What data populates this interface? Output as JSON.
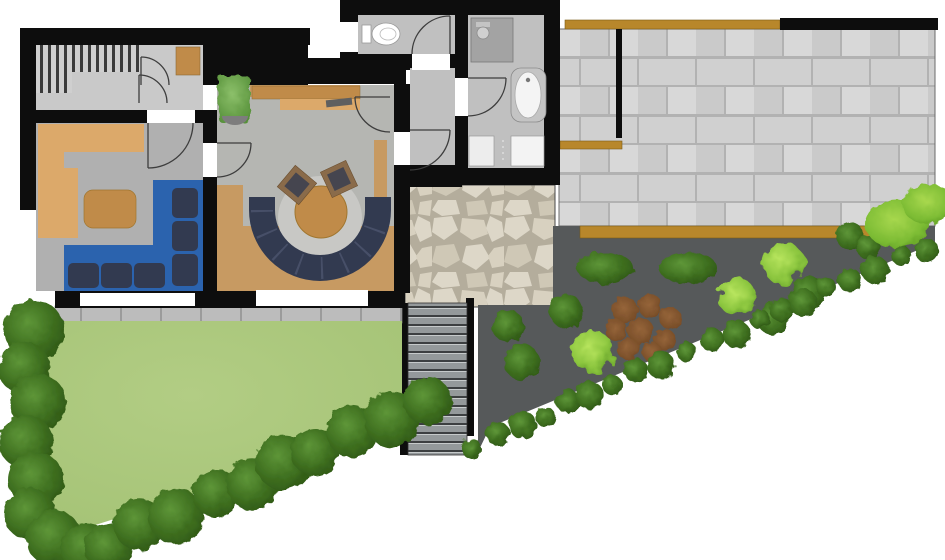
{
  "title": "Residential ground-floor plan with terrace and garden",
  "colors": {
    "wall": "#0d0d0d",
    "floor_a": "#c9c9c9",
    "floor_b": "#b0b0b0",
    "floor_c": "#b5b6b2",
    "floor_d": "#c0c0c0",
    "wood": "#c79a62",
    "wood_light": "#dca96a",
    "wood_dark": "#c08b49",
    "beam": "#b8872b",
    "sofa_blue": "#2b63ae",
    "sofa_navy": "#323a50",
    "garden": "#56595a",
    "paver": "#d0d0d0",
    "paver_joint": "#b2b2b2",
    "flag_joint": "#b4ad9c",
    "flag_stone": "#ddd7c8",
    "lawn": "#a9c77b",
    "hedge": "#3f7020",
    "shrub_light": "#8cc63f",
    "mulch": "#7c4f2b",
    "stair_tread": "#94999b"
  },
  "rooms": [
    {
      "name": "staircase-hall",
      "features": [
        "interior-stairs",
        "dresser",
        "doors"
      ]
    },
    {
      "name": "lounge",
      "features": [
        "wood-floor-l",
        "side-table",
        "blue-corner-sofa"
      ]
    },
    {
      "name": "living-room",
      "features": [
        "sideboard",
        "laptop",
        "potted-plant",
        "round-table",
        "u-shaped-sofa",
        "two-armchairs",
        "wood-floor"
      ]
    },
    {
      "name": "vestibule",
      "features": [
        "doors"
      ]
    },
    {
      "name": "wc",
      "features": [
        "toilet"
      ]
    },
    {
      "name": "bathroom",
      "features": [
        "shower",
        "bathtub",
        "washing-machines"
      ]
    }
  ],
  "outdoor": [
    {
      "name": "paver-terrace",
      "features": [
        "timber-beam-top",
        "timber-beam-bottom",
        "timber-beam-left",
        "black-wall",
        "divider-wall"
      ]
    },
    {
      "name": "flagstone-patio"
    },
    {
      "name": "outdoor-stairs"
    },
    {
      "name": "paved-strip"
    },
    {
      "name": "lawn"
    },
    {
      "name": "garden-bed",
      "features": [
        "oval-bushes",
        "round-bushes",
        "light-shrubs",
        "mulch-patch",
        "corner-bush"
      ]
    }
  ],
  "plants": {
    "hedge_left_count": 8,
    "lawn_hedge_count": 10,
    "garden_hedge_count": 20,
    "oval_bush_count": 2,
    "round_bush_count": 5,
    "light_shrub_count": 3,
    "mulch_patch_count": 8,
    "corner_bush_count": 1
  }
}
